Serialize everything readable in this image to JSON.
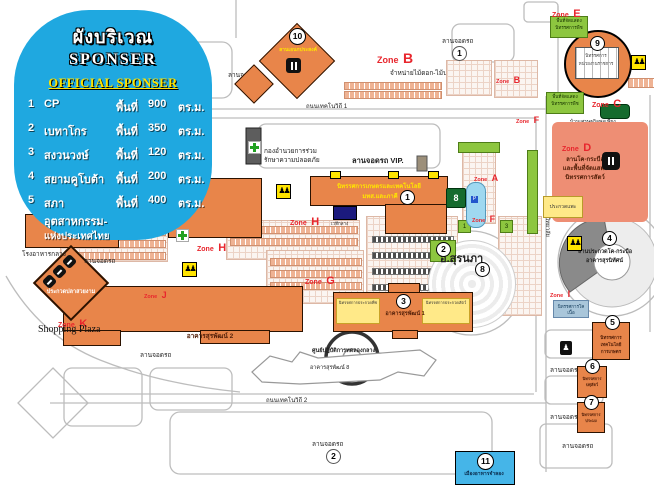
{
  "legend": {
    "title_th": "ผังบริเวณ",
    "title_en": "SPONSER",
    "subtitle": "OFFICIAL SPONSER",
    "sponsors": [
      {
        "num": "1",
        "name": "CP",
        "area_label": "พื้นที่",
        "area": "900",
        "unit": "ตร.ม."
      },
      {
        "num": "2",
        "name": "เบทาโกร",
        "area_label": "พื้นที่",
        "area": "350",
        "unit": "ตร.ม."
      },
      {
        "num": "3",
        "name": "สงวนวงษ์",
        "area_label": "พื้นที่",
        "area": "120",
        "unit": "ตร.ม."
      },
      {
        "num": "4",
        "name": "สยามคูโบต้า",
        "area_label": "พื้นที่",
        "area": "200",
        "unit": "ตร.ม."
      },
      {
        "num": "5",
        "name": "สภาอุตสาหกรรม-",
        "name2": "แห่งประเทศไทย",
        "area_label": "พื้นที่",
        "area": "400",
        "unit": "ตร.ม."
      }
    ]
  },
  "map": {
    "zone_word": "Zone",
    "zones": {
      "e": "E",
      "b_big": "B",
      "b_small": "B",
      "c": "C",
      "f_top": "F",
      "a": "A",
      "f_mid": "F",
      "d": "D",
      "g": "G",
      "h_west": "H",
      "h_mid": "H",
      "i": "I",
      "j": "J",
      "k": "K"
    },
    "labels": {
      "parking": "ลานจอดรถ",
      "parking_vip": "ลานจอดรถ VIP.",
      "parking1_num": "1",
      "parking2_num": "2",
      "road_techno1": "ถนนเทคโนวิถี 1",
      "road_techno2": "ถนนเทคโนวิถี 2",
      "road_university": "ถนนมหาวิทยาลัย",
      "flower_market": "จำหน่ายไม้ดอก-ไม้ประดับ",
      "security_l1": "กองอำนวยการร่วม",
      "security_l2": "รักษาความปลอดภัย",
      "canteen": "โรงอาหารกลาง",
      "shopping_plaza": "Shopping Plaza",
      "surapat2": "อาคารสุรพัฒน์ 2",
      "surapat8": "อาคารสุรพัฒน์ 8",
      "central_lab": "ศูนย์ปฏิบัติการทดลองกลาง",
      "suranapa": "อ.สุรนภา",
      "suranapa_num": "8",
      "goat_contest": "ประกวดแพะ",
      "sufficiency_house": "บ้านเศรษฐกิจพอเพียง",
      "organic_garden": "สวนเกษตรอินทรีย์",
      "exhibit_area_l1": "พื้นที่จัดแสดง",
      "exhibit_area_l2": "นิทรรศการพืช",
      "zone_d_l1": "ลานโค-กระบือ",
      "zone_d_l2": "และพื้นที่จัดแสดง",
      "zone_d_l3": "นิทรรศการสัตว์",
      "arena_l1": "ลานประกวดโค-กระบือ",
      "arena_l2": "อาคารสุรนิทัศน์",
      "arena_num": "4",
      "stage": "เวทีกลาง",
      "beef_expo": "นิทรรศการโคเนื้อ"
    },
    "buildings": {
      "b1": {
        "num": "1",
        "l1": "นิทรรศการเกษตรและเทคโนโลยี",
        "l2": "มทส.และภาคี"
      },
      "b3": {
        "num": "3",
        "name": "อาคารสุรพัฒน์ 1",
        "left": "นิทรรศการประกวดพืช",
        "right": "นิทรรศการประกวดสัตว์"
      },
      "b5": {
        "num": "5",
        "l1": "นิทรรศการ",
        "l2": "เทคโนโลยีการเกษตร"
      },
      "b6": {
        "num": "6",
        "l1": "นิทรรศการ",
        "l2": "ปศุสัตว์"
      },
      "b7": {
        "num": "7",
        "l1": "นิทรรศการ",
        "l2": "ประมง"
      },
      "b8": {
        "num": "8"
      },
      "b9": {
        "num": "9",
        "l1": "นิทรรศการ",
        "l2": "หน่วยงานราชการ"
      },
      "b10": {
        "num": "10",
        "name": "ลานเอนกประสงค์"
      },
      "b11": {
        "num": "11",
        "name": "เมืองอาหารจำลอง"
      },
      "fish": {
        "name": "ประกวดปลาสวยงาม"
      },
      "g1": {
        "num": "1"
      },
      "g2": {
        "num": "2"
      },
      "g3": {
        "num": "3"
      }
    },
    "colors": {
      "accent_blue": "#1fa8e0",
      "zone_red": "#e8262d",
      "building_orange": "#e8854a",
      "zone_green": "#8dc63f",
      "zone_salmon": "#ee8e74",
      "highlight_yellow": "#ffe400"
    }
  }
}
